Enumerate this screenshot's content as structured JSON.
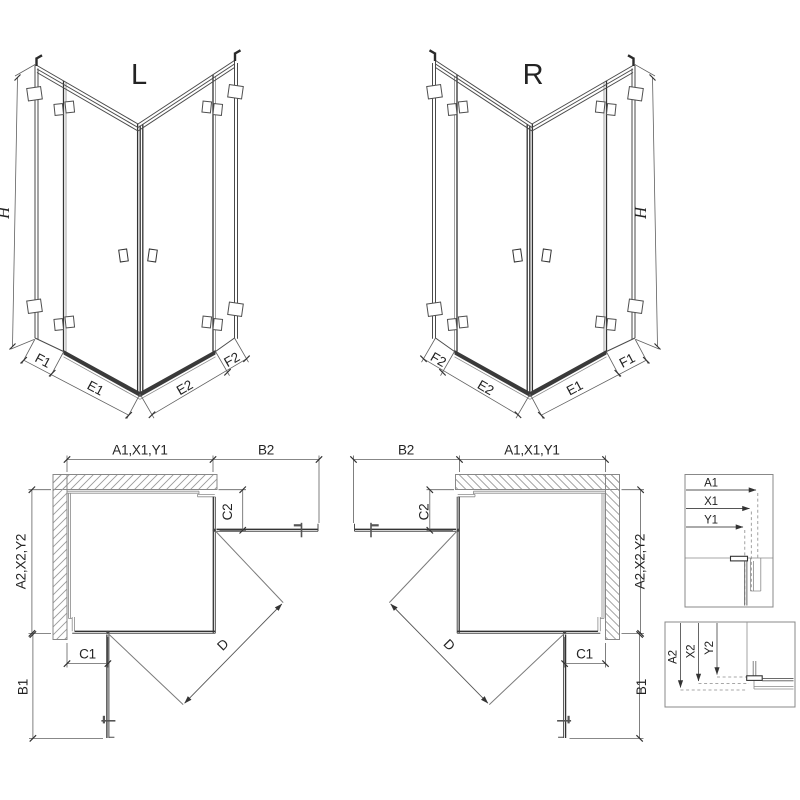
{
  "drawing": {
    "iso_left": {
      "label": "L",
      "h": "H",
      "f1": "F1",
      "e1": "E1",
      "e2": "E2",
      "f2": "F2"
    },
    "iso_right": {
      "label": "R",
      "h": "H",
      "f1": "F1",
      "e1": "E1",
      "e2": "E2",
      "f2": "F2"
    },
    "plan_left": {
      "width_top": "A1,X1,Y1",
      "door_top": "B2",
      "fixed_right": "C2",
      "depth_left": "A2,X2,Y2",
      "fixed_bottom": "C1",
      "door_side": "B1",
      "diagonal": "D"
    },
    "plan_right": {
      "width_top": "A1,X1,Y1",
      "door_top": "B2",
      "fixed_right": "C2",
      "depth_left": "A2,X2,Y2",
      "fixed_bottom": "C1",
      "door_side": "B1",
      "diagonal": "D"
    },
    "detail_top": {
      "a": "A1",
      "x": "X1",
      "y": "Y1"
    },
    "detail_bottom": {
      "a": "A2",
      "x": "X2",
      "y": "Y2"
    }
  }
}
